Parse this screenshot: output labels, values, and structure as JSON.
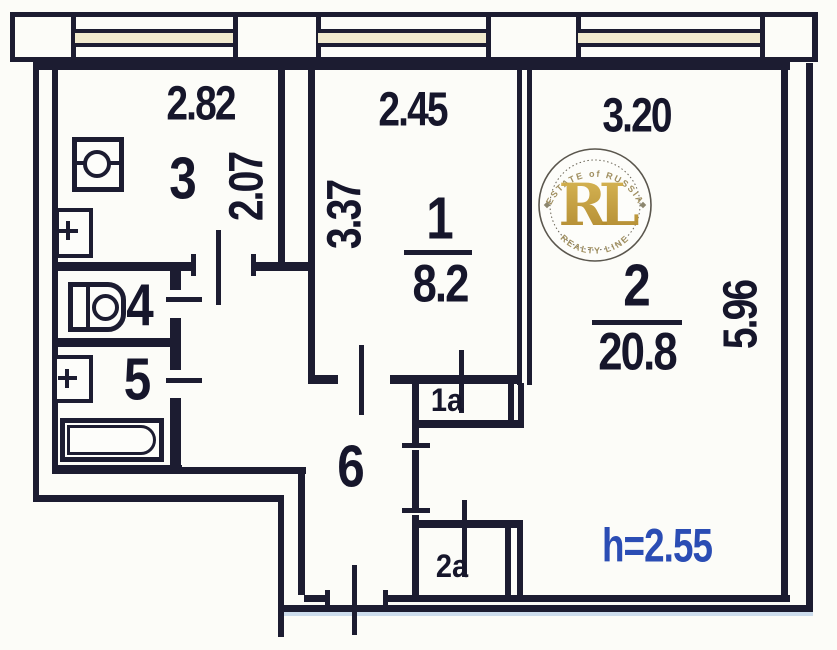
{
  "plan": {
    "ceiling_height_label": "h=2.55",
    "rooms": [
      {
        "id": "1",
        "area": "8.2",
        "width": "2.45",
        "depth": "3.37"
      },
      {
        "id": "2",
        "area": "20.8",
        "width": "3.20",
        "depth": "5.96"
      },
      {
        "id": "3",
        "width": "2.82",
        "depth": "2.07"
      },
      {
        "id": "4"
      },
      {
        "id": "5"
      },
      {
        "id": "6"
      },
      {
        "id": "1a"
      },
      {
        "id": "2a"
      }
    ]
  },
  "watermark": {
    "monogram": "RL",
    "arc_top": "ESTATE of RUSSIA",
    "arc_bottom": "REALTY LINE"
  },
  "colors": {
    "wall": "#1c1c31",
    "dimension_text": "#16162b",
    "height_text": "#2b4db4",
    "watermark_gold": "#c49b3b",
    "window_glass": "#f0e9ce"
  }
}
